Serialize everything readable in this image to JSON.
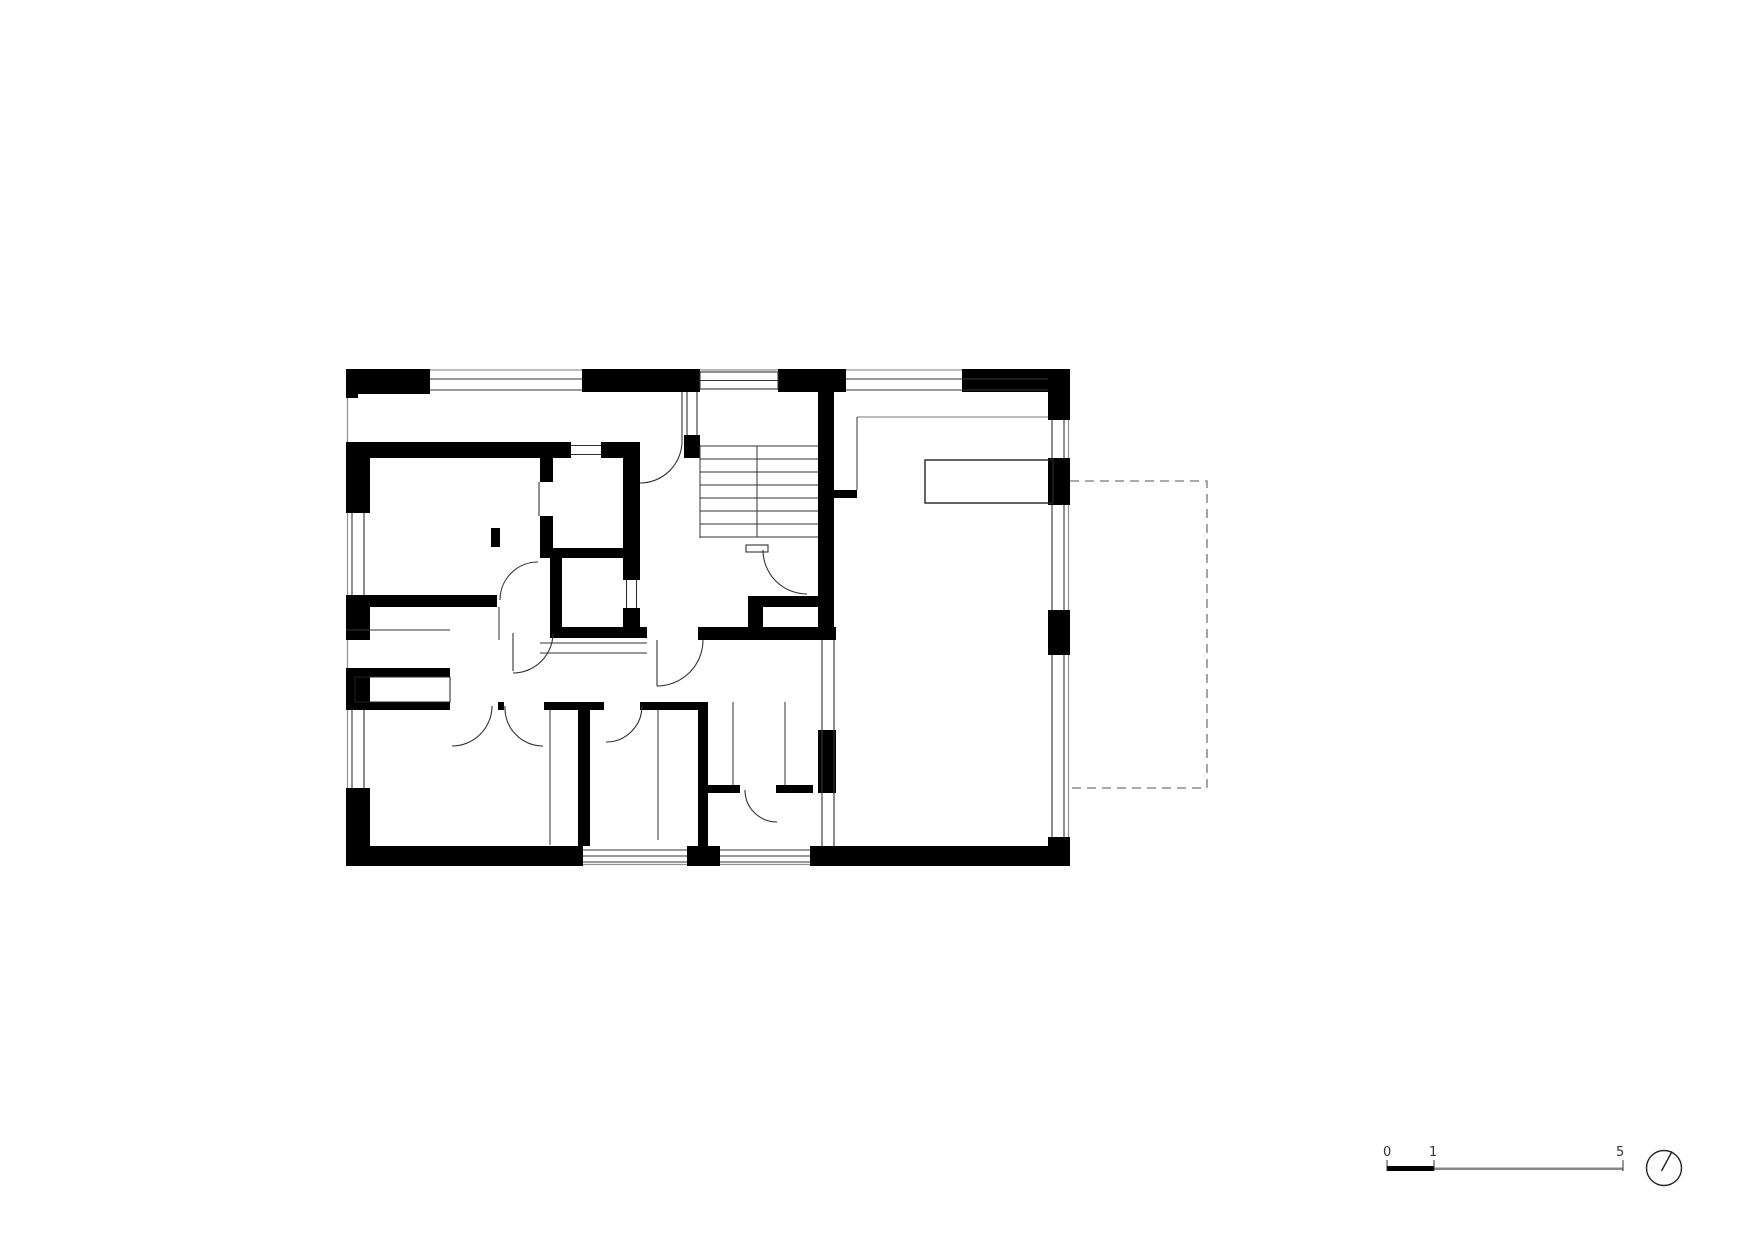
{
  "meta": {
    "drawing_type": "architectural-floor-plan",
    "background": "#ffffff"
  },
  "colors": {
    "wall": "#000000",
    "detail_line": "#333333",
    "face_line": "#919191",
    "dashed_line": "#777777",
    "furniture_line": "#222222",
    "text": "#333333"
  },
  "scale_bar": {
    "labels": [
      "0",
      "1",
      "5"
    ]
  },
  "north_indicator": {
    "symbol": "circle-with-needle"
  }
}
